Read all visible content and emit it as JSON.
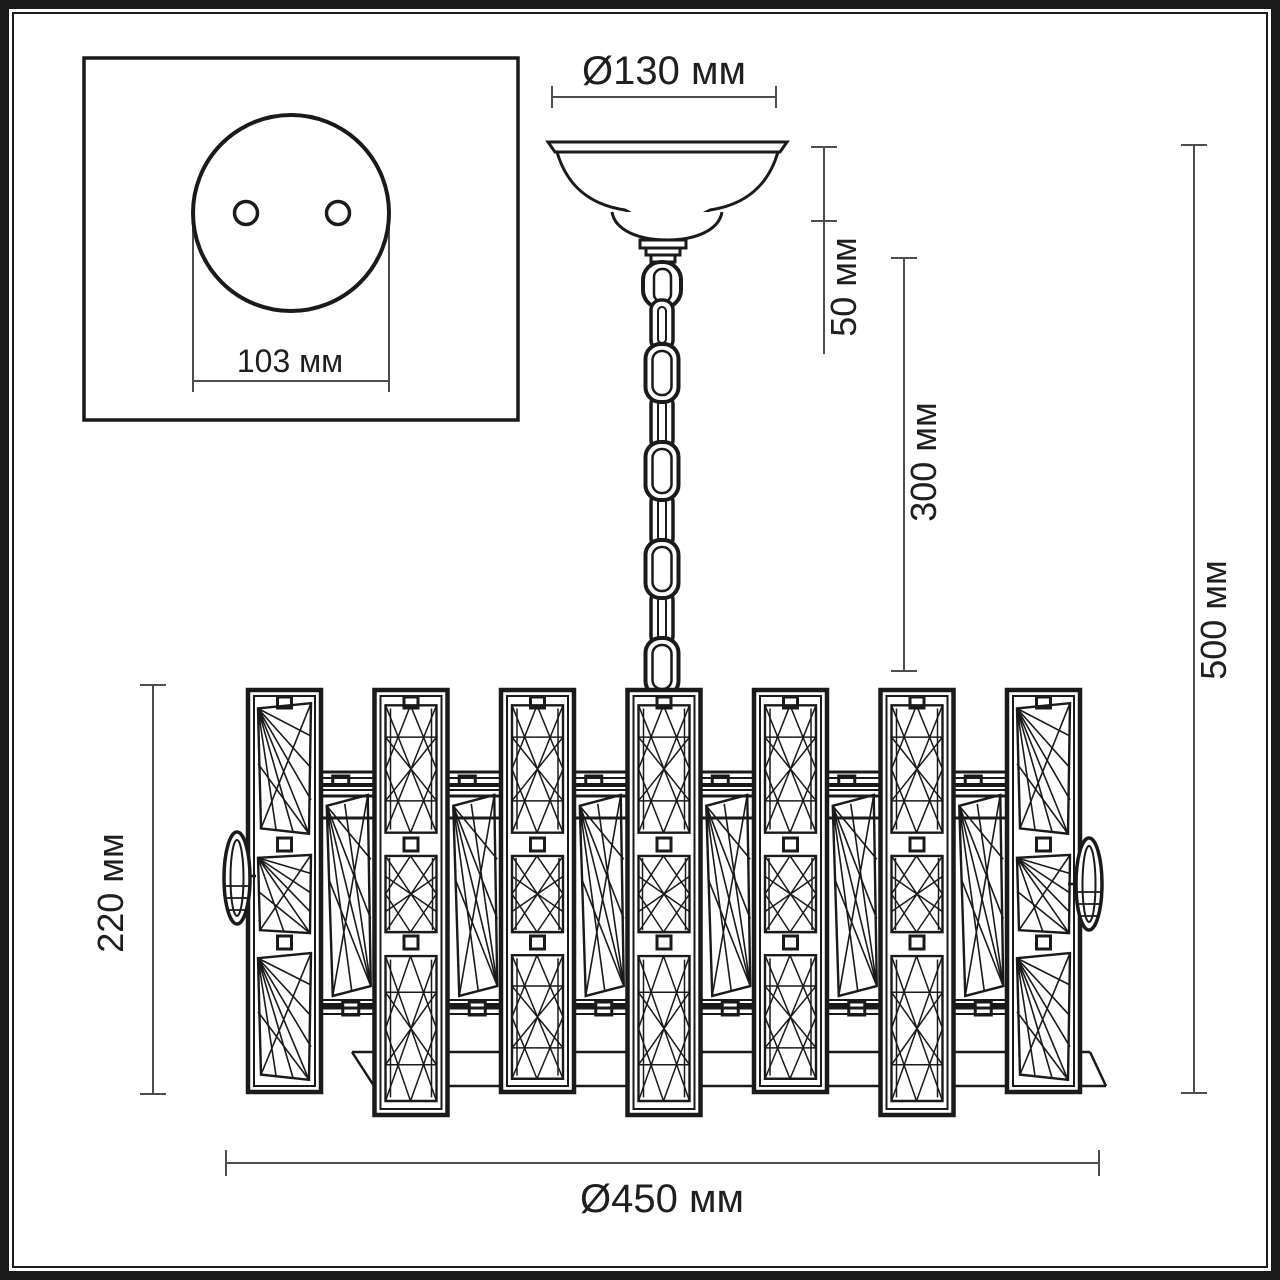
{
  "colors": {
    "background": "#ffffff",
    "ink": "#1a1a1a",
    "dimension_lines": "#4d4d4d"
  },
  "labels": {
    "mount_hole_spacing": "103 мм",
    "canopy_diameter": "Ø130 мм",
    "canopy_height": "50 мм",
    "chain_length": "300 мм",
    "total_height": "500 мм",
    "body_height": "220 мм",
    "body_diameter": "Ø450 мм"
  }
}
